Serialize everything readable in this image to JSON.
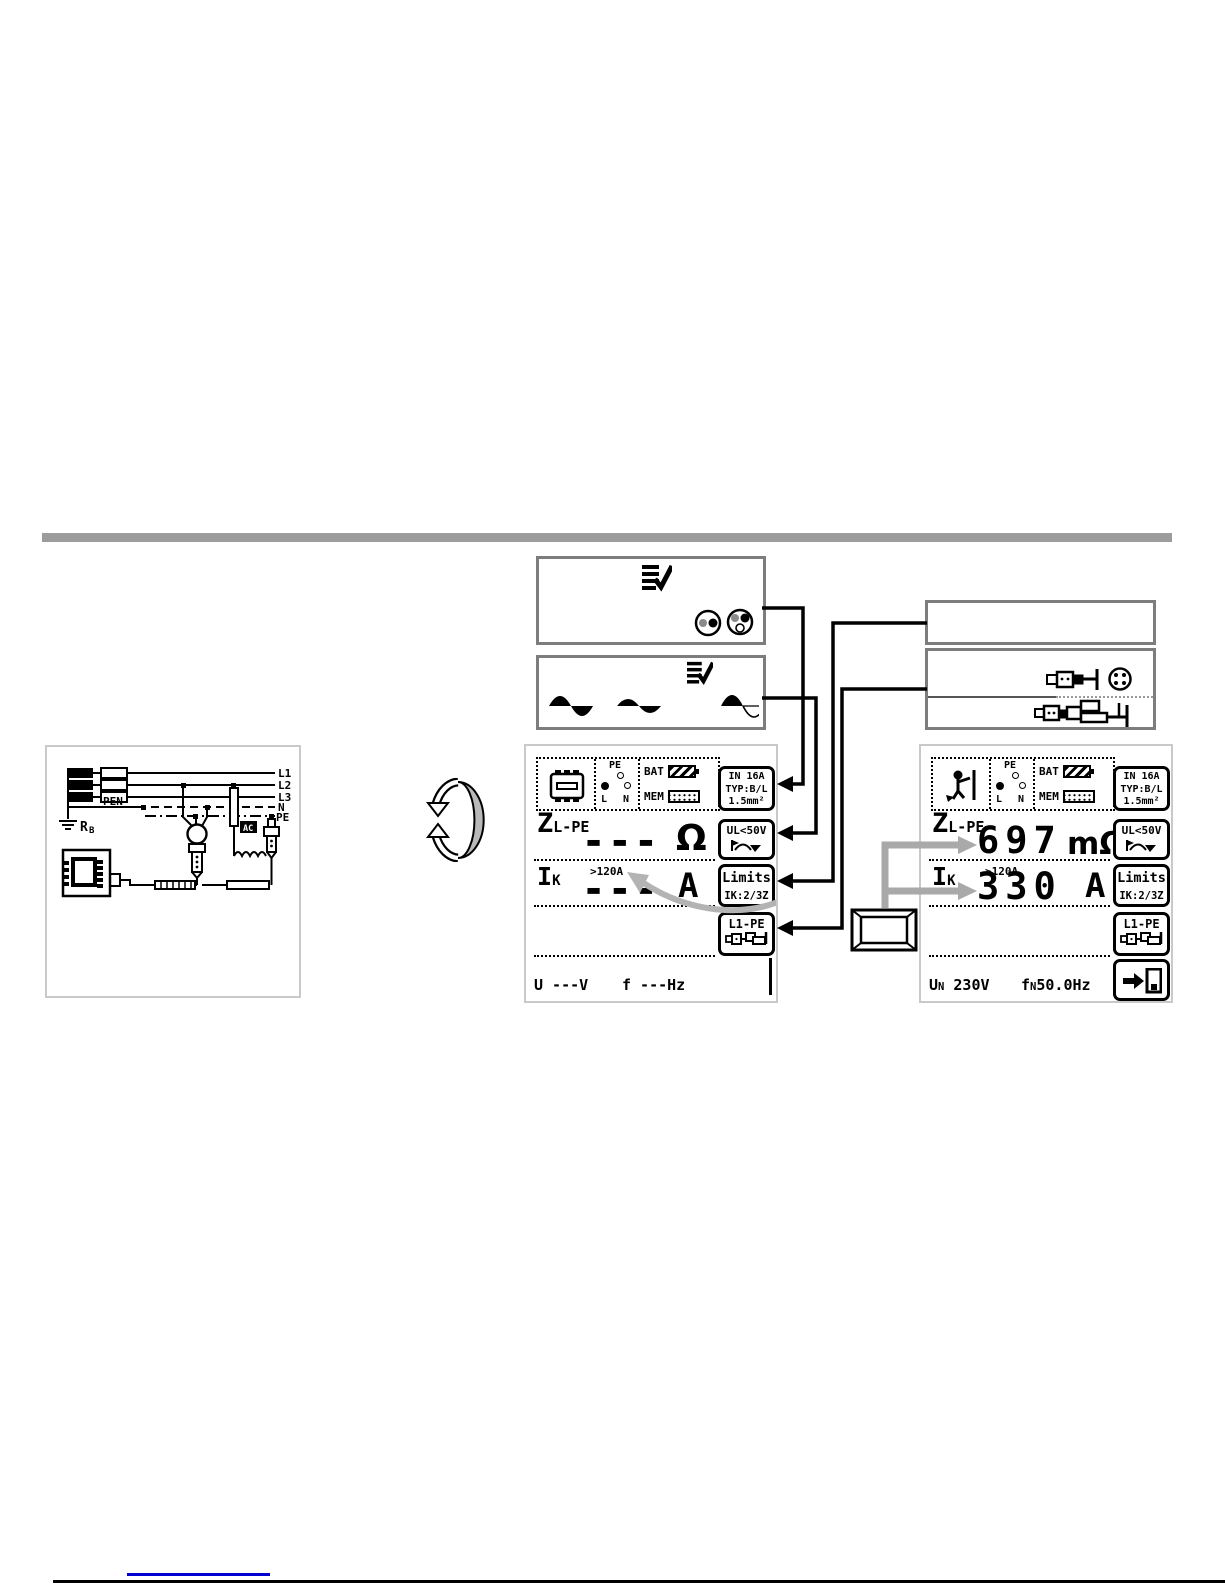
{
  "screens": {
    "pre": {
      "status": {
        "pe": "PE",
        "l": "L",
        "n": "N",
        "bat": "BAT",
        "mem": "MEM"
      },
      "z": {
        "label_main": "Z",
        "label_sub": "L-PE",
        "value": "▬ ▬ ▬",
        "unit": "Ω"
      },
      "ik": {
        "label_main": "I",
        "label_sub": "K",
        "range": ">120A",
        "value": "▬ ▬ ▬",
        "unit": "A"
      },
      "bottom": {
        "left": "U  ---V",
        "right": "f  ---Hz"
      },
      "softkeys": {
        "k1": {
          "l1": "IN 16A",
          "l2": "TYP:B/L",
          "l3": "1.5mm²"
        },
        "k2": {
          "l1": "UL<50V"
        },
        "k3": {
          "l1": "Limits",
          "l2": "IK:2/3Z"
        },
        "k4": {
          "l1": "L1-PE"
        }
      }
    },
    "post": {
      "status": {
        "pe": "PE",
        "l": "L",
        "n": "N",
        "bat": "BAT",
        "mem": "MEM"
      },
      "z": {
        "label_main": "Z",
        "label_sub": "L-PE",
        "value": "697",
        "unit": "mΩ"
      },
      "ik": {
        "label_main": "I",
        "label_sub": "K",
        "range": ">120A",
        "value": "330",
        "unit": "A"
      },
      "bottom": {
        "u": "U",
        "u_sub": "N",
        "u_val": " 230V",
        "f": "f",
        "f_sub": "N",
        "f_val": "50.0Hz"
      },
      "softkeys": {
        "k1": {
          "l1": "IN 16A",
          "l2": "TYP:B/L",
          "l3": "1.5mm²"
        },
        "k2": {
          "l1": "UL<50V"
        },
        "k3": {
          "l1": "Limits",
          "l2": "IK:2/3Z"
        },
        "k4": {
          "l1": "L1-PE"
        }
      }
    }
  },
  "circuit": {
    "l1": "L1",
    "l2": "L2",
    "l3": "L3",
    "n": "N",
    "pe": "PE",
    "pen": "PEN",
    "rb_main": "R",
    "rb_sub": "B",
    "ac": "AC"
  },
  "colors": {
    "divider": "#9c9c9c",
    "link": "#0000d0",
    "arrow_gray": "#a9a9a9",
    "arrow_curve": "#b3b3b3"
  }
}
